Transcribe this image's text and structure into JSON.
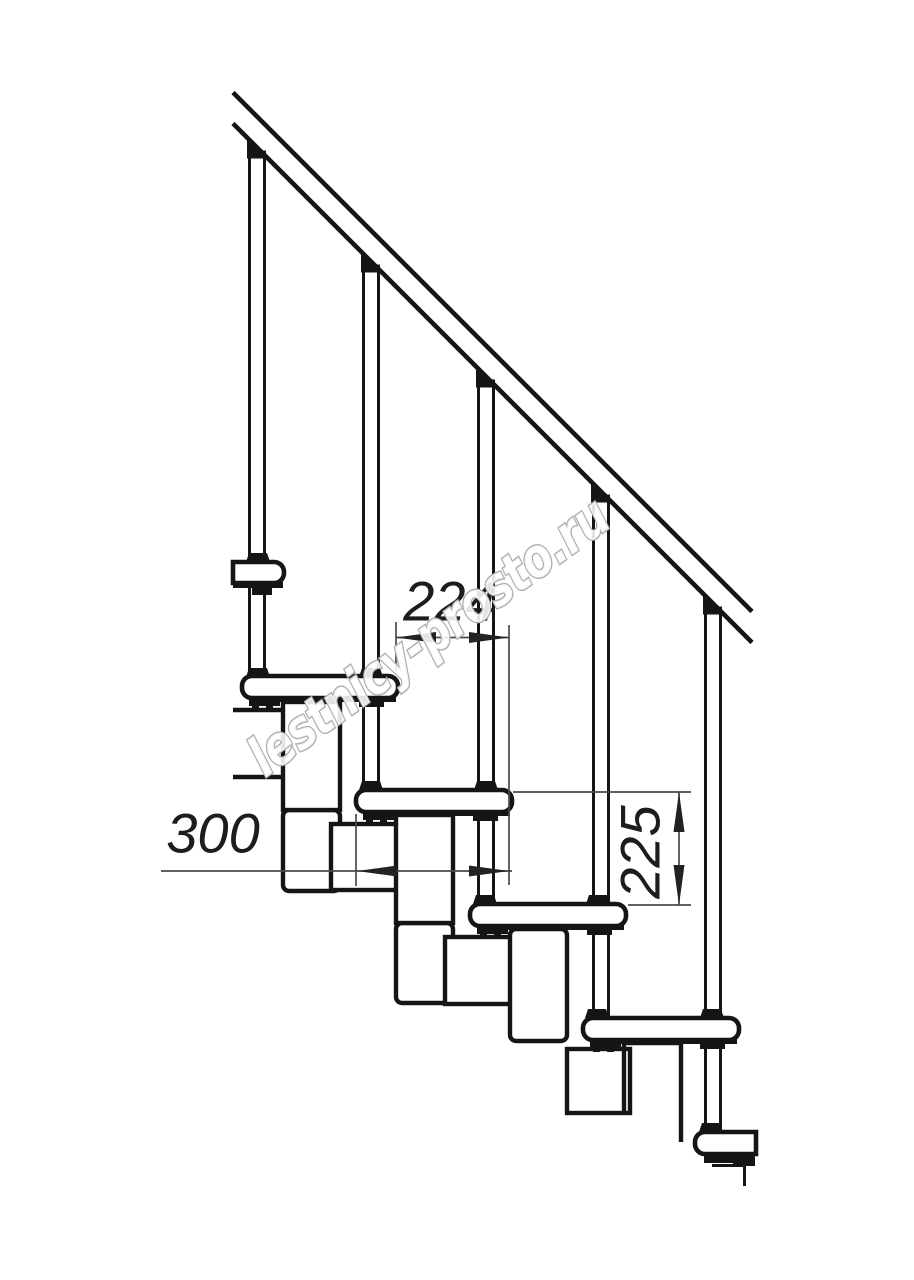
{
  "drawing": {
    "title": "modular-staircase-side-view",
    "background": "#ffffff",
    "colors": {
      "line": "#151515",
      "dim_line": "#4a4a4a",
      "dim_text": "#1d1d1d",
      "watermark_stroke": "#ababab",
      "watermark_fill": "#ffffff"
    },
    "watermark": {
      "text": "lestnicy-prosto.ru",
      "x": 265,
      "y": 778,
      "rotate": -36,
      "font_size": 54,
      "scale_x": 0.82
    },
    "dimensions": [
      {
        "id": "step-run",
        "label": "224",
        "orientation": "horizontal",
        "text": {
          "x": 450,
          "y": 601,
          "size": 56,
          "rotate": 0
        },
        "line": {
          "x1": 396,
          "y1": 637.5,
          "x2": 509,
          "y2": 637.5
        },
        "ext": [
          {
            "x1": 396,
            "y1": 622,
            "x2": 396,
            "y2": 671
          },
          {
            "x1": 509,
            "y1": 625,
            "x2": 509,
            "y2": 885
          }
        ],
        "arrows": [
          {
            "x": 396,
            "y": 637.5,
            "dir": "left"
          },
          {
            "x": 509,
            "y": 637.5,
            "dir": "right"
          }
        ]
      },
      {
        "id": "tread-depth",
        "label": "300",
        "orientation": "horizontal",
        "text": {
          "x": 213,
          "y": 833,
          "size": 56,
          "rotate": 0
        },
        "line": {
          "x1": 161,
          "y1": 871,
          "x2": 512,
          "y2": 871
        },
        "ext": [
          {
            "x1": 356,
            "y1": 814,
            "x2": 356,
            "y2": 886
          }
        ],
        "arrows": [
          {
            "x": 357,
            "y": 871,
            "dir": "left"
          },
          {
            "x": 509,
            "y": 871,
            "dir": "right"
          }
        ]
      },
      {
        "id": "riser-height",
        "label": "225",
        "orientation": "vertical",
        "text": {
          "x": 640,
          "y": 852,
          "size": 56,
          "rotate": -90
        },
        "line": {
          "x1": 679,
          "y1": 792,
          "x2": 679,
          "y2": 905
        },
        "ext": [
          {
            "x1": 513,
            "y1": 792,
            "x2": 691,
            "y2": 792
          },
          {
            "x1": 628,
            "y1": 905,
            "x2": 691,
            "y2": 905
          }
        ],
        "arrows": [
          {
            "x": 679,
            "y": 792,
            "dir": "up"
          },
          {
            "x": 679,
            "y": 905,
            "dir": "down"
          }
        ]
      }
    ],
    "figure": {
      "stroke_main": 4.4,
      "stroke_thin": 1.7,
      "rail": {
        "lines": [
          {
            "x1": 233,
            "y1": 92.5,
            "x2": 752,
            "y2": 611.5
          },
          {
            "x1": 233,
            "y1": 123.5,
            "x2": 752,
            "y2": 642.5
          }
        ],
        "width": 4.6
      },
      "balusters": [
        {
          "cx": 257,
          "top": 152,
          "bottom": 677
        },
        {
          "cx": 371,
          "top": 266,
          "bottom": 790
        },
        {
          "cx": 486,
          "top": 381,
          "bottom": 904
        },
        {
          "cx": 601,
          "top": 496,
          "bottom": 1018
        },
        {
          "cx": 713,
          "top": 608,
          "bottom": 1132
        }
      ],
      "baluster_width": 15,
      "treads": [
        {
          "x": 242,
          "y": 676,
          "w": 156,
          "h": 22,
          "round": "both"
        },
        {
          "x": 356,
          "y": 790,
          "w": 156,
          "h": 22,
          "round": "both"
        },
        {
          "x": 470,
          "y": 904,
          "w": 156,
          "h": 22,
          "round": "both"
        },
        {
          "x": 583,
          "y": 1018,
          "w": 156,
          "h": 22,
          "round": "both"
        }
      ],
      "tread_fragments": [
        {
          "x": 233,
          "y": 562,
          "w": 51,
          "h": 21,
          "round": "right"
        },
        {
          "x": 695,
          "y": 1132,
          "w": 61,
          "h": 22,
          "round": "left"
        }
      ],
      "under_strips": [
        {
          "L": 242,
          "T": 676
        },
        {
          "L": 356,
          "T": 790
        },
        {
          "L": 470,
          "T": 904
        },
        {
          "L": 583,
          "T": 1018
        }
      ],
      "modules": [
        {
          "C": {
            "x": 233,
            "y": 710,
            "w": 55,
            "h": 67,
            "openLeft": true
          },
          "U": {
            "x": 283,
            "y": 702,
            "w": 57,
            "h": 108
          },
          "D": {
            "x": 283,
            "y": 810,
            "w": 57,
            "h": 81,
            "fillet": true
          }
        },
        {
          "C": {
            "x": 331,
            "y": 824,
            "w": 71,
            "h": 66
          },
          "U": {
            "x": 396,
            "y": 815,
            "w": 57,
            "h": 108
          },
          "D": {
            "x": 396,
            "y": 923,
            "w": 57,
            "h": 80,
            "fillet": true
          }
        },
        {
          "C": {
            "x": 445,
            "y": 937,
            "w": 71,
            "h": 67
          },
          "U": {
            "x": 510,
            "y": 929,
            "w": 57,
            "h": 112,
            "fillet": true
          }
        },
        {
          "C": {
            "x": 567,
            "y": 1049,
            "w": 63,
            "h": 64
          },
          "U": {
            "x": 624,
            "y": 1043,
            "w": 57,
            "cutLeft": 69,
            "cutRight": 99
          }
        }
      ],
      "collars": [
        {
          "x": 246,
          "y": 553
        },
        {
          "x": 246,
          "y": 668
        },
        {
          "x": 359,
          "y": 668
        },
        {
          "x": 359,
          "y": 781
        },
        {
          "x": 474,
          "y": 781
        },
        {
          "x": 473,
          "y": 895
        },
        {
          "x": 586,
          "y": 895
        },
        {
          "x": 585,
          "y": 1009
        },
        {
          "x": 700,
          "y": 1009
        },
        {
          "x": 699,
          "y": 1123
        }
      ],
      "top_fragment_marks": [
        {
          "type": "rect",
          "x": 233,
          "y": 582,
          "w": 50,
          "h": 6
        },
        {
          "type": "rect",
          "x": 252,
          "y": 588,
          "w": 20,
          "h": 7
        }
      ],
      "bottom_fragment_marks": [
        {
          "type": "rect",
          "x": 704,
          "y": 1153,
          "w": 33,
          "h": 10
        },
        {
          "type": "rect",
          "x": 733,
          "y": 1156,
          "w": 22,
          "h": 10
        },
        {
          "type": "path",
          "d": "M 712 1165.5 H 744.5 V 1186"
        }
      ]
    }
  }
}
